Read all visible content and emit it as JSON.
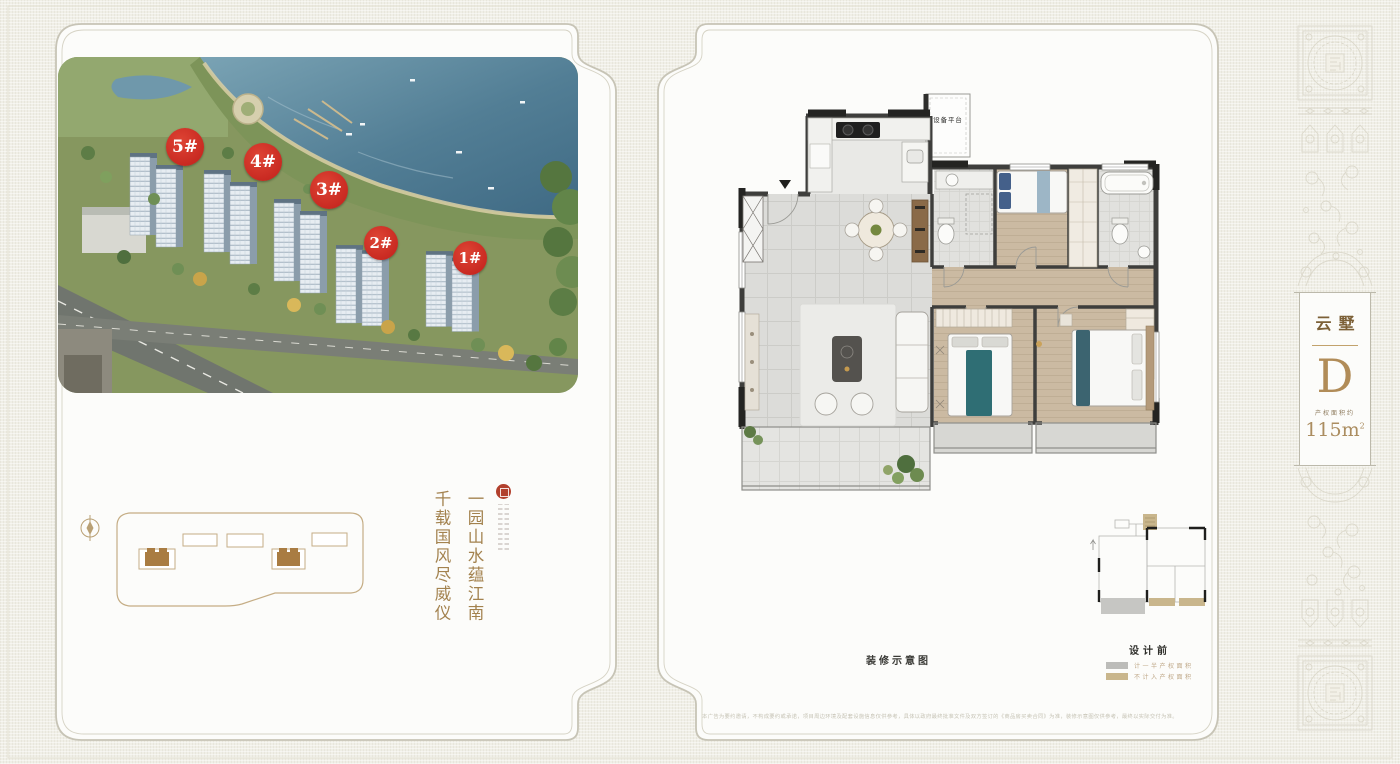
{
  "colors": {
    "accent_red": "#cf2b24",
    "gold_text": "#a3824e",
    "unit_gold": "#b18c58",
    "legend_gray": "#bcbcb9",
    "legend_tan": "#c9b68c",
    "panel_border": "#c7c4b6",
    "background": "#f0efe7"
  },
  "left_panel": {
    "badges": [
      {
        "label": "5#"
      },
      {
        "label": "4#"
      },
      {
        "label": "3#"
      },
      {
        "label": "2#"
      },
      {
        "label": "1#"
      }
    ],
    "poem": {
      "line_right": "一园山水蕴江南",
      "line_left": "千载国风尽威仪"
    }
  },
  "right_panel": {
    "floor_plan": {
      "equipment_platform": "设备平台"
    },
    "caption": "装修示意图",
    "key_plan_title": "设计前",
    "legend": [
      {
        "label": "计一半产权面积",
        "swatch_color": "#bcbcb9",
        "swatch_style": "background:#bcbcb9"
      },
      {
        "label": "不计入产权面积",
        "swatch_color": "#c9b68c",
        "swatch_style": "background:#c9b68c"
      }
    ],
    "disclaimer": "本广告为要约邀请，不构成要约或承诺，项目周边环境及配套设施信息仅供参考，具体以政府最终批准文件及双方签订的《商品房买卖合同》为准，装修示意图仅供参考，最终以实际交付为准。"
  },
  "unit_card": {
    "series": "云墅",
    "unit": "D",
    "area_prefix": "产权面积约",
    "area_number": "115",
    "area_unit_base": "m",
    "area_unit_sup": "2"
  }
}
